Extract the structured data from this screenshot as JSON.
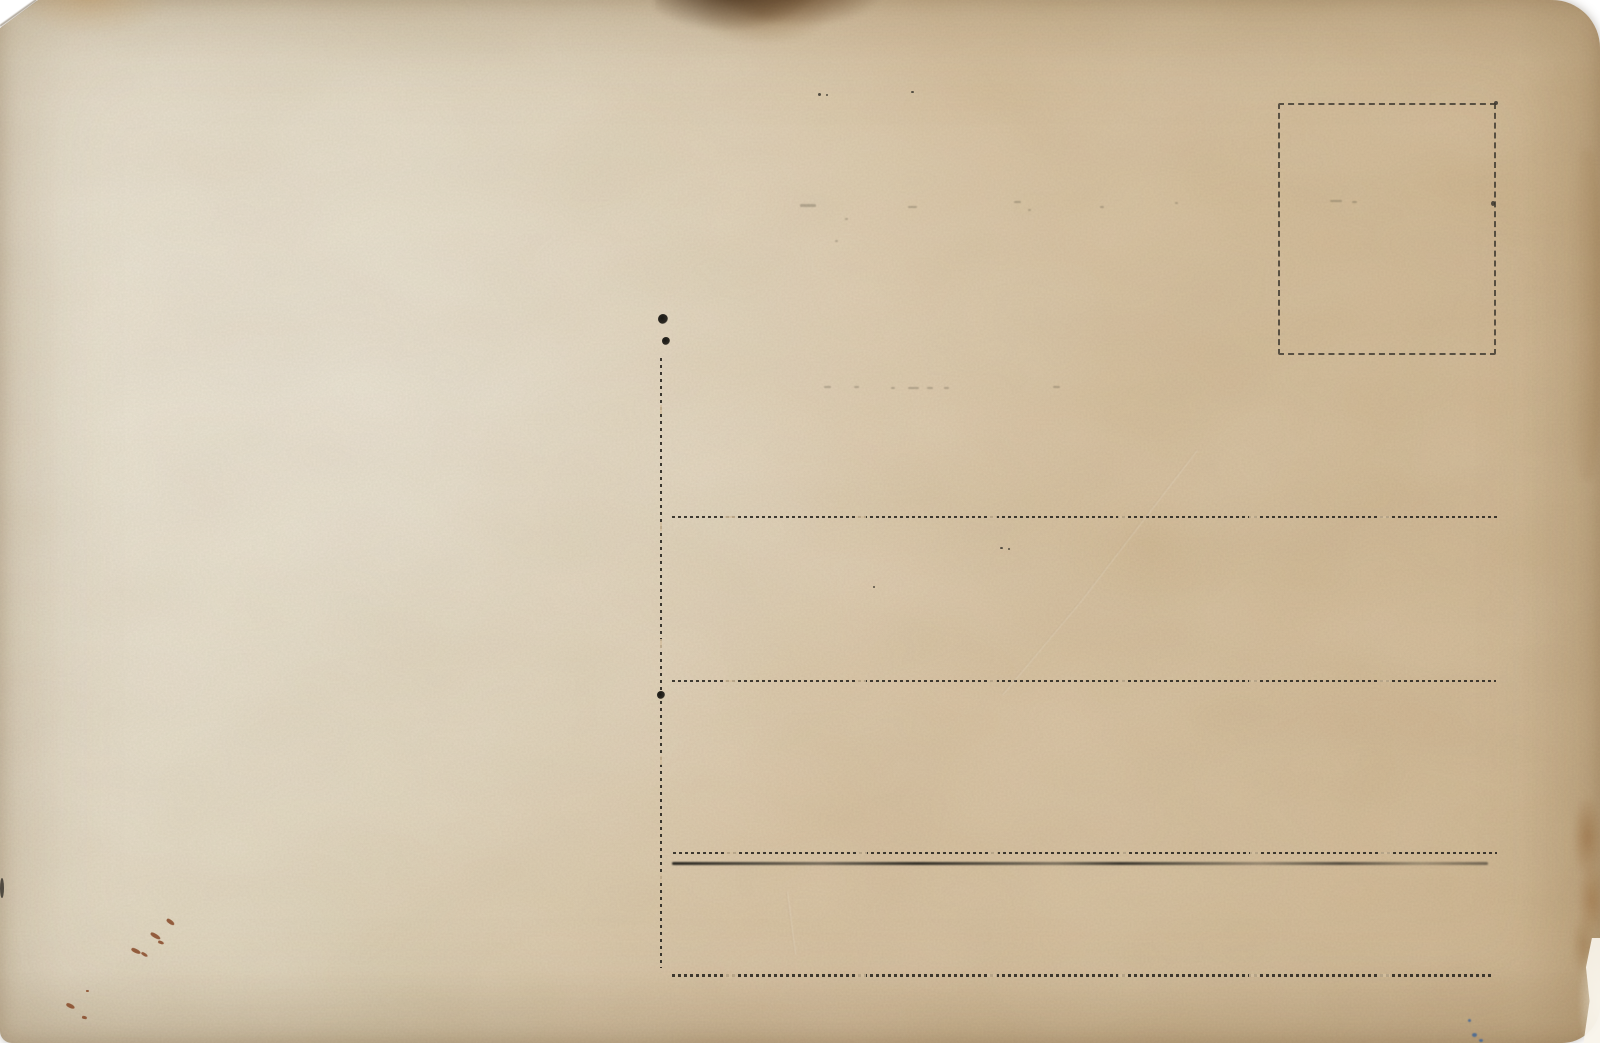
{
  "scene": {
    "kind": "scanned vintage postcard, blank back (no printed or written text)",
    "background": "#ffffff"
  },
  "postcard": {
    "width": 1600,
    "height": 1043,
    "colors": {
      "paper": "#d9c4a3",
      "paper_light": "#e7dfcc",
      "paper_dark": "#cdb38c",
      "ink": "#2b2923",
      "rust": "#8a4a28",
      "blue_ink": "#33619f",
      "stain_brown": "#5e3c1e"
    },
    "stamp_box": {
      "x": 1278,
      "y": 103,
      "w": 218,
      "h": 252
    },
    "divider": {
      "x": 660,
      "y1": 358,
      "y2": 968
    },
    "ink_blobs": [
      {
        "x": 663,
        "y": 319,
        "r": 5
      },
      {
        "x": 666,
        "y": 341,
        "r": 4
      },
      {
        "x": 661,
        "y": 695,
        "r": 4
      }
    ],
    "lines": [
      {
        "y": 517,
        "x1": 672,
        "x2": 1497,
        "weight": 2,
        "style": "dashed"
      },
      {
        "y": 681,
        "x1": 672,
        "x2": 1496,
        "weight": 2,
        "style": "dashed"
      },
      {
        "y": 853,
        "x1": 673,
        "x2": 1497,
        "weight": 2,
        "style": "dashed"
      },
      {
        "y": 863,
        "x1": 672,
        "x2": 1488,
        "weight": 3,
        "style": "smear"
      },
      {
        "y": 975,
        "x1": 672,
        "x2": 1491,
        "weight": 3,
        "style": "dashed"
      }
    ],
    "stains": [
      {
        "name": "top-burn-stain",
        "class": "stain-top-burn",
        "x": 655,
        "y": -16,
        "w": 230,
        "h": 70
      },
      {
        "name": "top-left-tint-stain",
        "class": "stain-topleft",
        "x": 18,
        "y": -8,
        "w": 160,
        "h": 55
      },
      {
        "name": "right-edge-blotch-stain",
        "class": "stain-right-blotch",
        "x": 1556,
        "y": 798,
        "w": 46,
        "h": 175
      },
      {
        "name": "right-edge-tint-stain",
        "class": "stain-right-tint",
        "x": 1570,
        "y": 150,
        "w": 32,
        "h": 330
      },
      {
        "name": "center-soft-stain",
        "class": "stain-soft",
        "x": 1040,
        "y": 470,
        "w": 220,
        "h": 160
      },
      {
        "name": "bottom-right-worn-stain",
        "class": "stain-worn",
        "x": 1566,
        "y": 930,
        "w": 36,
        "h": 115
      }
    ],
    "specks": [
      {
        "class": "rust",
        "x": 166,
        "y": 920,
        "w": 9,
        "h": 4,
        "rot": 35
      },
      {
        "class": "rust",
        "x": 150,
        "y": 934,
        "w": 11,
        "h": 4,
        "rot": 30
      },
      {
        "class": "rust",
        "x": 158,
        "y": 941,
        "w": 6,
        "h": 3,
        "rot": 20
      },
      {
        "class": "rust",
        "x": 131,
        "y": 949,
        "w": 10,
        "h": 4,
        "rot": 25
      },
      {
        "class": "rust",
        "x": 141,
        "y": 953,
        "w": 7,
        "h": 3,
        "rot": 30
      },
      {
        "class": "rust",
        "x": 66,
        "y": 1004,
        "w": 9,
        "h": 4,
        "rot": 25
      },
      {
        "class": "rust",
        "x": 82,
        "y": 1016,
        "w": 5,
        "h": 3,
        "rot": 10
      },
      {
        "class": "rust",
        "x": 86,
        "y": 990,
        "w": 3,
        "h": 2,
        "rot": 0
      },
      {
        "class": "blue",
        "x": 1468,
        "y": 1019,
        "w": 3,
        "h": 3,
        "rot": 0
      },
      {
        "class": "blue",
        "x": 1472,
        "y": 1033,
        "w": 5,
        "h": 4,
        "rot": 0
      },
      {
        "class": "blue",
        "x": 1479,
        "y": 1039,
        "w": 4,
        "h": 3,
        "rot": 0
      },
      {
        "class": "dark",
        "x": 818,
        "y": 93,
        "w": 3,
        "h": 3,
        "rot": 0
      },
      {
        "class": "dark",
        "x": 826,
        "y": 94,
        "w": 2,
        "h": 2,
        "rot": 0
      },
      {
        "class": "dark",
        "x": 911,
        "y": 91,
        "w": 3,
        "h": 2,
        "rot": 0
      },
      {
        "class": "dark",
        "x": 1000,
        "y": 547,
        "w": 3,
        "h": 2,
        "rot": 0
      },
      {
        "class": "dark",
        "x": 1008,
        "y": 548,
        "w": 2,
        "h": 2,
        "rot": 0
      },
      {
        "class": "dark",
        "x": 873,
        "y": 586,
        "w": 2,
        "h": 2,
        "rot": 0
      },
      {
        "class": "dark",
        "x": 0,
        "y": 878,
        "w": 4,
        "h": 20,
        "rot": 0
      },
      {
        "class": "dark",
        "x": 1494,
        "y": 101,
        "w": 4,
        "h": 4,
        "rot": 0
      },
      {
        "class": "dark",
        "x": 1491,
        "y": 201,
        "w": 4,
        "h": 5,
        "rot": 0
      },
      {
        "class": "ghost",
        "x": 800,
        "y": 204,
        "w": 16,
        "h": 3,
        "rot": 0
      },
      {
        "class": "ghost",
        "x": 908,
        "y": 206,
        "w": 9,
        "h": 2,
        "rot": 0
      },
      {
        "class": "ghost",
        "x": 1014,
        "y": 201,
        "w": 7,
        "h": 2,
        "rot": 0
      },
      {
        "class": "ghost",
        "x": 1028,
        "y": 209,
        "w": 3,
        "h": 2,
        "rot": 0
      },
      {
        "class": "ghost",
        "x": 1100,
        "y": 206,
        "w": 4,
        "h": 2,
        "rot": 0
      },
      {
        "class": "ghost",
        "x": 1175,
        "y": 202,
        "w": 3,
        "h": 2,
        "rot": 0
      },
      {
        "class": "ghost",
        "x": 845,
        "y": 218,
        "w": 3,
        "h": 2,
        "rot": 0
      },
      {
        "class": "ghost",
        "x": 835,
        "y": 240,
        "w": 3,
        "h": 2,
        "rot": 0
      },
      {
        "class": "ghost",
        "x": 824,
        "y": 386,
        "w": 7,
        "h": 2,
        "rot": 0
      },
      {
        "class": "ghost",
        "x": 854,
        "y": 386,
        "w": 5,
        "h": 2,
        "rot": 0
      },
      {
        "class": "ghost",
        "x": 891,
        "y": 387,
        "w": 4,
        "h": 2,
        "rot": 0
      },
      {
        "class": "ghost",
        "x": 908,
        "y": 387,
        "w": 11,
        "h": 2,
        "rot": 0
      },
      {
        "class": "ghost",
        "x": 927,
        "y": 387,
        "w": 6,
        "h": 2,
        "rot": 0
      },
      {
        "class": "ghost",
        "x": 944,
        "y": 387,
        "w": 5,
        "h": 2,
        "rot": 0
      },
      {
        "class": "ghost",
        "x": 1053,
        "y": 386,
        "w": 7,
        "h": 2,
        "rot": 0
      },
      {
        "class": "ghost",
        "x": 1330,
        "y": 200,
        "w": 12,
        "h": 2,
        "rot": 0
      },
      {
        "class": "ghost",
        "x": 1352,
        "y": 201,
        "w": 5,
        "h": 2,
        "rot": 0
      }
    ],
    "creases": [
      {
        "x1": 1197,
        "y1": 449,
        "x2": 1080,
        "y2": 601
      },
      {
        "x1": 1080,
        "y1": 601,
        "x2": 1002,
        "y2": 694
      },
      {
        "x1": 787,
        "y1": 891,
        "x2": 795,
        "y2": 953
      }
    ]
  }
}
